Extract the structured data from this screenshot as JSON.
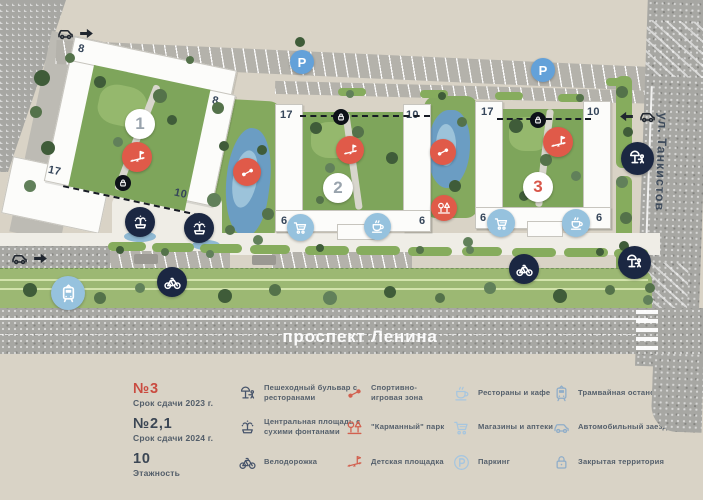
{
  "map": {
    "streets": {
      "bottom": "проспект Ленина",
      "right": "ул. Танкистов"
    },
    "buildings": [
      {
        "badge": "1",
        "badge_color": "gray",
        "floors": {
          "tl": "8",
          "tr": "8",
          "bl": "17",
          "br": "10"
        }
      },
      {
        "badge": "2",
        "badge_color": "gray",
        "floors": {
          "tl": "17",
          "tr": "10",
          "bl": "6",
          "br": "6"
        }
      },
      {
        "badge": "3",
        "badge_color": "red",
        "floors": {
          "tl": "17",
          "tr": "10",
          "bl": "6",
          "br": "6"
        }
      }
    ],
    "markers": [
      {
        "name": "building-1-badge",
        "text": "1",
        "x": 140,
        "y": 124,
        "d": 30,
        "theme": "white"
      },
      {
        "name": "building-2-badge",
        "text": "2",
        "x": 338,
        "y": 188,
        "d": 30,
        "theme": "white"
      },
      {
        "name": "building-3-badge",
        "text": "3",
        "x": 538,
        "y": 187,
        "d": 30,
        "theme": "white",
        "accent": true
      },
      {
        "name": "playground-1",
        "icon": "playground",
        "x": 137,
        "y": 157,
        "d": 30,
        "theme": "red"
      },
      {
        "name": "playground-2",
        "icon": "playground",
        "x": 350,
        "y": 150,
        "d": 28,
        "theme": "red"
      },
      {
        "name": "playground-3",
        "icon": "playground",
        "x": 558,
        "y": 142,
        "d": 30,
        "theme": "red"
      },
      {
        "name": "sport-zone-1",
        "icon": "dumbbell",
        "x": 247,
        "y": 172,
        "d": 28,
        "theme": "red"
      },
      {
        "name": "sport-zone-2",
        "icon": "dumbbell",
        "x": 443,
        "y": 152,
        "d": 26,
        "theme": "red"
      },
      {
        "name": "pocket-park",
        "icon": "pocket-park",
        "x": 444,
        "y": 208,
        "d": 26,
        "theme": "red"
      },
      {
        "name": "fountain-plaza-1",
        "icon": "fountain",
        "x": 140,
        "y": 222,
        "d": 30,
        "theme": "navy"
      },
      {
        "name": "fountain-plaza-2",
        "icon": "fountain",
        "x": 199,
        "y": 228,
        "d": 30,
        "theme": "navy"
      },
      {
        "name": "bike-path-1",
        "icon": "bicycle",
        "x": 172,
        "y": 282,
        "d": 30,
        "theme": "navy"
      },
      {
        "name": "bike-path-2",
        "icon": "bicycle",
        "x": 524,
        "y": 269,
        "d": 30,
        "theme": "navy"
      },
      {
        "name": "boulevard-1",
        "icon": "boulevard",
        "x": 637,
        "y": 158,
        "d": 33,
        "theme": "navy"
      },
      {
        "name": "boulevard-2",
        "icon": "boulevard",
        "x": 634,
        "y": 262,
        "d": 33,
        "theme": "navy"
      },
      {
        "name": "tram-stop",
        "icon": "tram",
        "x": 68,
        "y": 293,
        "d": 34,
        "theme": "sky"
      },
      {
        "name": "shops-2",
        "icon": "cart",
        "x": 300,
        "y": 227,
        "d": 27,
        "theme": "sky"
      },
      {
        "name": "cafe-2",
        "icon": "cafe",
        "x": 377,
        "y": 226,
        "d": 27,
        "theme": "sky"
      },
      {
        "name": "shops-3",
        "icon": "cart",
        "x": 501,
        "y": 223,
        "d": 28,
        "theme": "sky"
      },
      {
        "name": "cafe-3",
        "icon": "cafe",
        "x": 576,
        "y": 223,
        "d": 28,
        "theme": "sky"
      },
      {
        "name": "parking-1",
        "text": "P",
        "x": 302,
        "y": 62,
        "d": 24,
        "theme": "blue"
      },
      {
        "name": "parking-2",
        "text": "P",
        "x": 543,
        "y": 70,
        "d": 24,
        "theme": "blue"
      },
      {
        "name": "gate-lock-1",
        "icon": "lock",
        "x": 123,
        "y": 183,
        "d": 16,
        "theme": "black"
      },
      {
        "name": "gate-lock-2",
        "icon": "lock",
        "x": 341,
        "y": 117,
        "d": 16,
        "theme": "black"
      },
      {
        "name": "gate-lock-3",
        "icon": "lock",
        "x": 538,
        "y": 120,
        "d": 16,
        "theme": "black"
      }
    ],
    "car_entries": [
      {
        "name": "car-entry-northwest",
        "x": 56,
        "y": 24,
        "dir": "right"
      },
      {
        "name": "car-entry-west",
        "x": 10,
        "y": 249,
        "dir": "right"
      },
      {
        "name": "car-entry-east",
        "x": 618,
        "y": 107,
        "dir": "left"
      }
    ]
  },
  "legend": {
    "text_entries": [
      {
        "title": "№3",
        "subtitle": "Срок сдачи 2023 г.",
        "accent": true
      },
      {
        "title": "№2,1",
        "subtitle": "Срок сдачи 2024 г.",
        "accent": false
      },
      {
        "title": "10",
        "subtitle": "Этажность",
        "accent": false
      }
    ],
    "icon_entries": [
      {
        "icon": "boulevard",
        "theme": "navy",
        "label": "Пешеходный бульвар с ресторанами"
      },
      {
        "icon": "fountain",
        "theme": "navy",
        "label": "Центральная площадь с сухими фонтанами"
      },
      {
        "icon": "bicycle",
        "theme": "navy",
        "label": "Велодорожка"
      },
      {
        "icon": "dumbbell",
        "theme": "red",
        "label": "Спортивно- игровая зона"
      },
      {
        "icon": "pocket-park",
        "theme": "red",
        "label": "\"Карманный\" парк"
      },
      {
        "icon": "playground",
        "theme": "red",
        "label": "Детская площадка"
      },
      {
        "icon": "cafe",
        "theme": "lightblue",
        "label": "Рестораны и кафе"
      },
      {
        "icon": "cart",
        "theme": "lightblue",
        "label": "Магазины и аптеки"
      },
      {
        "icon": "parking",
        "theme": "lightblue",
        "label": "Паркинг"
      },
      {
        "icon": "tram",
        "theme": "steel",
        "label": "Трамвайная остановка"
      },
      {
        "icon": "car",
        "theme": "steel",
        "label": "Автомобильный заезд"
      },
      {
        "icon": "lock",
        "theme": "steel",
        "label": "Закрытая территория"
      }
    ]
  },
  "colors": {
    "background": "#d9d3c6",
    "accent_red": "#e05a49",
    "navy": "#1b2742",
    "light_blue": "#96c2de",
    "parking_blue": "#63a1d9",
    "lawn": "#9cb873",
    "courtyard": "#7ea55b",
    "pond": "#6b9dc3",
    "asphalt": "#a7a7a3"
  }
}
